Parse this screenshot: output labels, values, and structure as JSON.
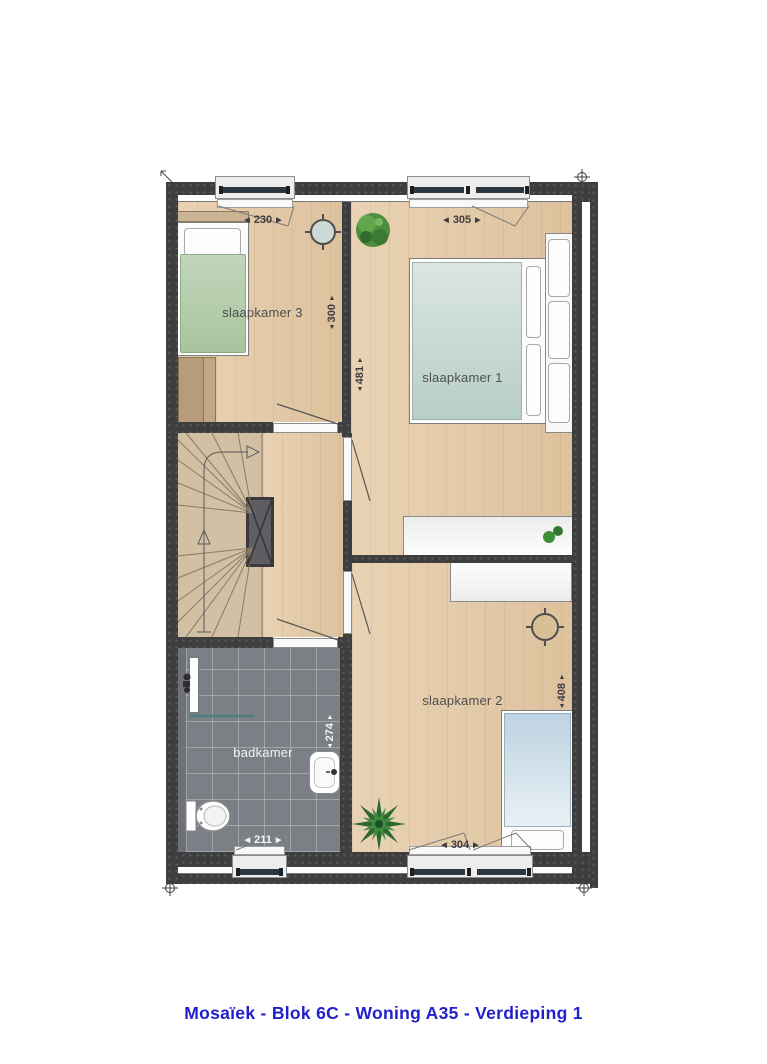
{
  "title": "Mosaïek - Blok 6C - Woning A35 - Verdieping 1",
  "ui": {
    "arrow_left": "◀",
    "arrow_right": "▶",
    "arrow_up": "▲",
    "arrow_down": "▼"
  },
  "rooms": {
    "slaapkamer1": "slaapkamer 1",
    "slaapkamer2": "slaapkamer 2",
    "slaapkamer3": "slaapkamer 3",
    "badkamer": "badkamer"
  },
  "dimensions_cm": {
    "slaapkamer3_width": "230",
    "slaapkamer3_depth": "300",
    "slaapkamer1_width": "305",
    "slaapkamer1_depth": "481",
    "badkamer_width": "211",
    "badkamer_depth": "274",
    "slaapkamer2_width": "304",
    "slaapkamer2_depth": "408"
  },
  "colors": {
    "title_blue": "#2121cc",
    "wall_dark": "#3e3e3e",
    "floor_wood": "#e4c8a2",
    "bathroom_tile": "#7b8086",
    "duvet_green": "#b3cda9",
    "duvet_teal": "#c0d4cb",
    "duvet_blue": "#c3d7e3",
    "glazing": "#2b3740"
  }
}
